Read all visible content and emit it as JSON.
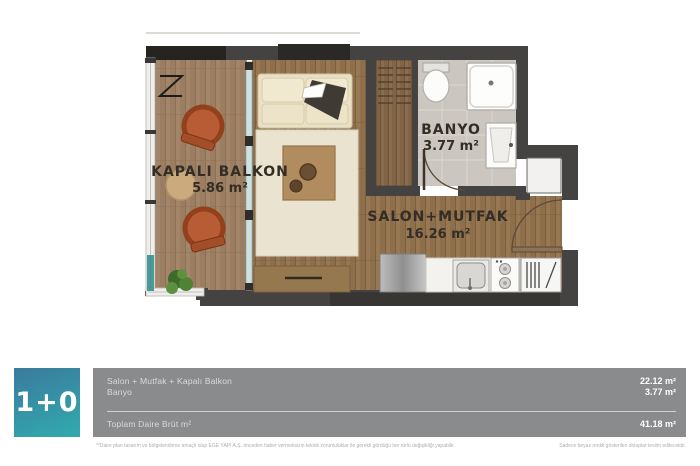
{
  "floor_plan": {
    "rooms": [
      {
        "name": "KAPALI BALKON",
        "area": "5.86 m²"
      },
      {
        "name": "BANYO",
        "area": "3.77 m²"
      },
      {
        "name": "SALON+MUTFAK",
        "area": "16.26 m²"
      }
    ]
  },
  "unit": {
    "type": "1+0"
  },
  "summary": {
    "rows": [
      {
        "label": "Salon + Mutfak + Kapalı Balkon",
        "value": "22.12 m²"
      },
      {
        "label": "Banyo",
        "value": "3.77 m²"
      }
    ],
    "total": {
      "label": "Toplam Daire Brüt m²",
      "value": "41.18 m²"
    }
  },
  "footnotes": {
    "left": "**Daire plan tasarım ve bölgelendirme amaçlı olup EGE YAPI A.Ş. önceden haber vermeksizin teknik zorunluluklar ile gerekli gördüğü her türlü değişikliği yapabilir.",
    "right": "Sadece beyaz renkli gösterilen dolaplar teslim edilecektir."
  },
  "colors": {
    "accent_blue": "#3b7a9e",
    "accent_teal": "#31abad",
    "panel_gray": "#8a8b8d",
    "wall_dark": "#454341",
    "wood_balcony": "#a3866a",
    "wood_salon": "#977853",
    "bathroom_tile": "#cbc7c0",
    "chair_orange": "#b85c36"
  }
}
